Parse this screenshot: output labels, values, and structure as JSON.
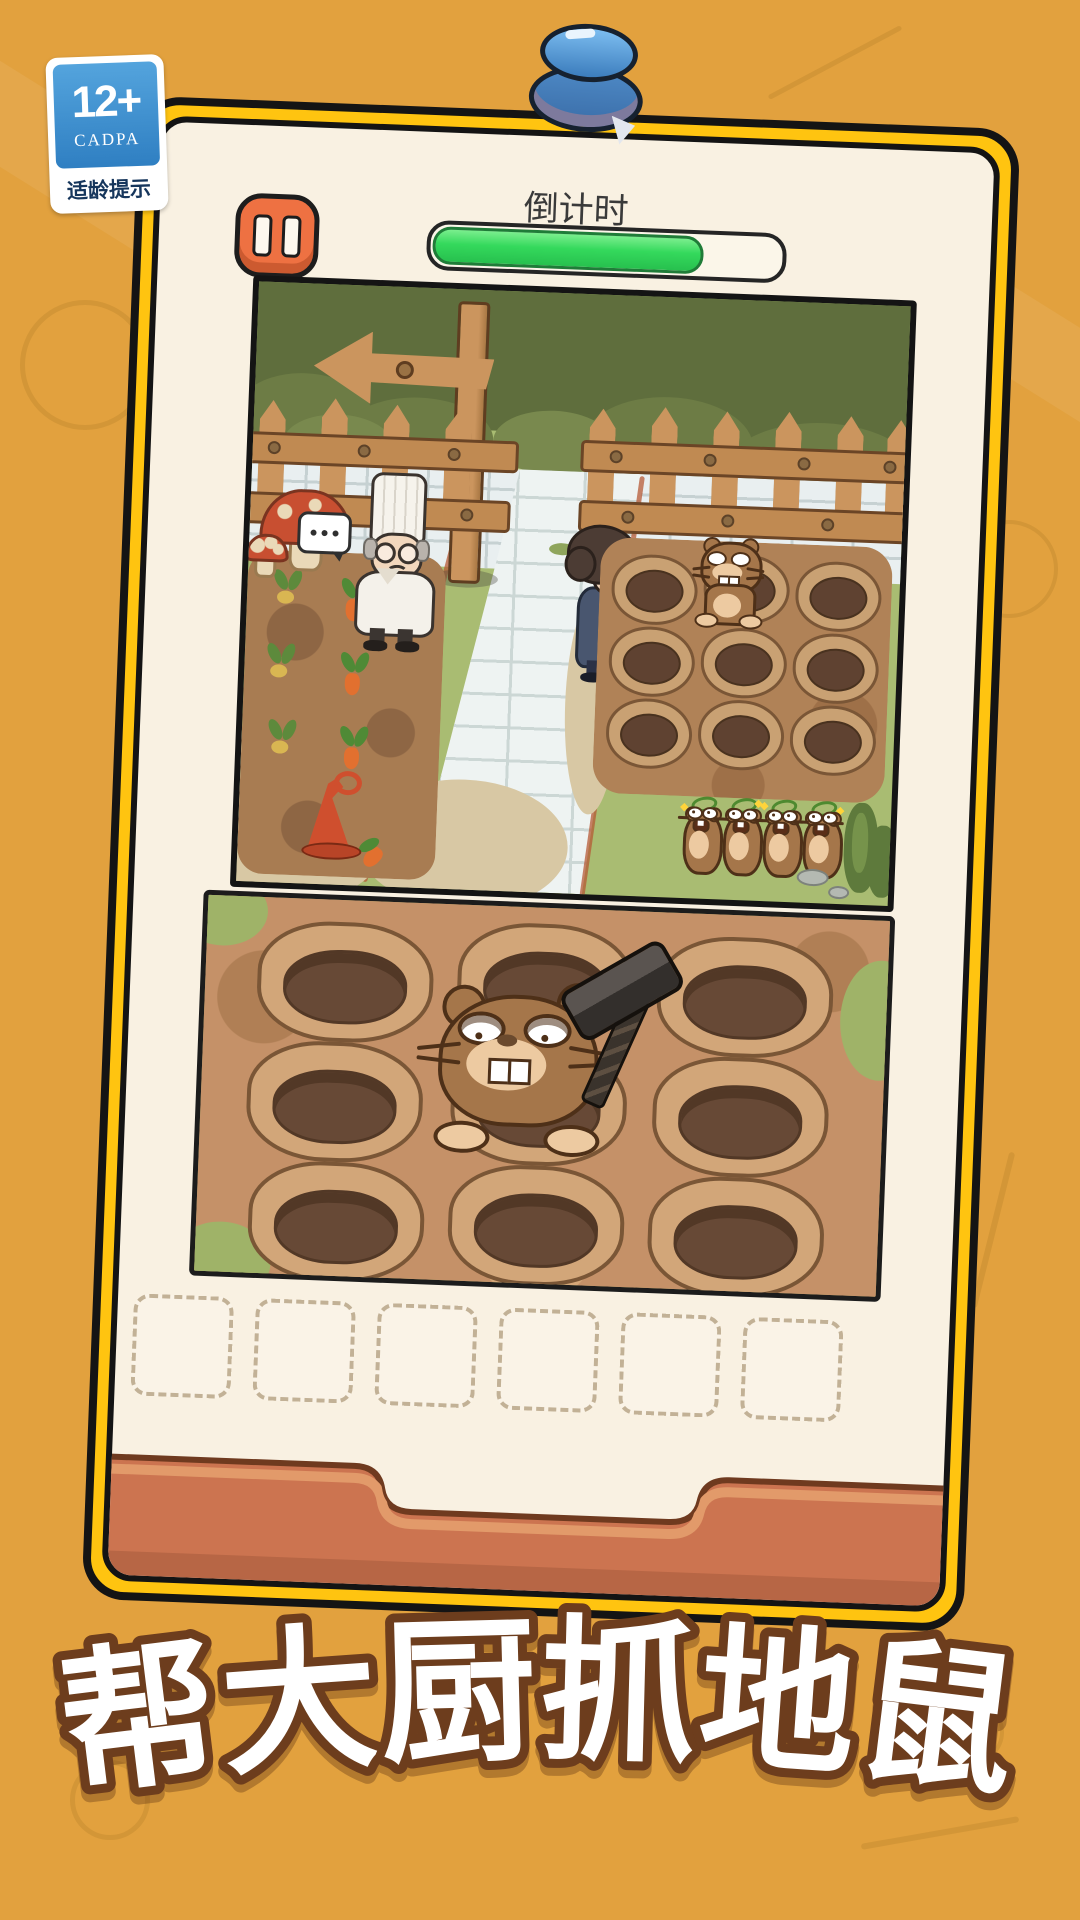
{
  "background": {
    "color": "#e2a13e",
    "doodle_color": "#8a5c10"
  },
  "age_rating_badge": {
    "rating": "12+",
    "organization": "CADPA",
    "caption": "适龄提示",
    "panel_color": "#3f93d2"
  },
  "pushpin": {
    "color": "#4a8fd0"
  },
  "card": {
    "frame_color": "#ffc410",
    "panel_color": "#f9f1e2"
  },
  "hud": {
    "countdown_label": "倒计时",
    "progress_percent": 77,
    "progress_color": "#34d95c",
    "pause_color": "#ee7142"
  },
  "scene_top": {
    "description": "garden scene with chef, detective, carrot patch, left-arrow signpost, fence",
    "mole_holes": 9,
    "popped_moles": 1,
    "standing_moles": 4,
    "characters": [
      "chef",
      "detective"
    ]
  },
  "scene_bottom": {
    "description": "close-up whack-a-mole field",
    "mole_holes": 9,
    "moles": 1,
    "tool": "hammer"
  },
  "inventory": {
    "slot_count": 6
  },
  "title": {
    "text": "帮大厨抓地鼠",
    "chars": [
      "帮",
      "大",
      "厨",
      "抓",
      "地",
      "鼠"
    ],
    "fill": "#ffffff",
    "outline": "#6d3d1d"
  }
}
